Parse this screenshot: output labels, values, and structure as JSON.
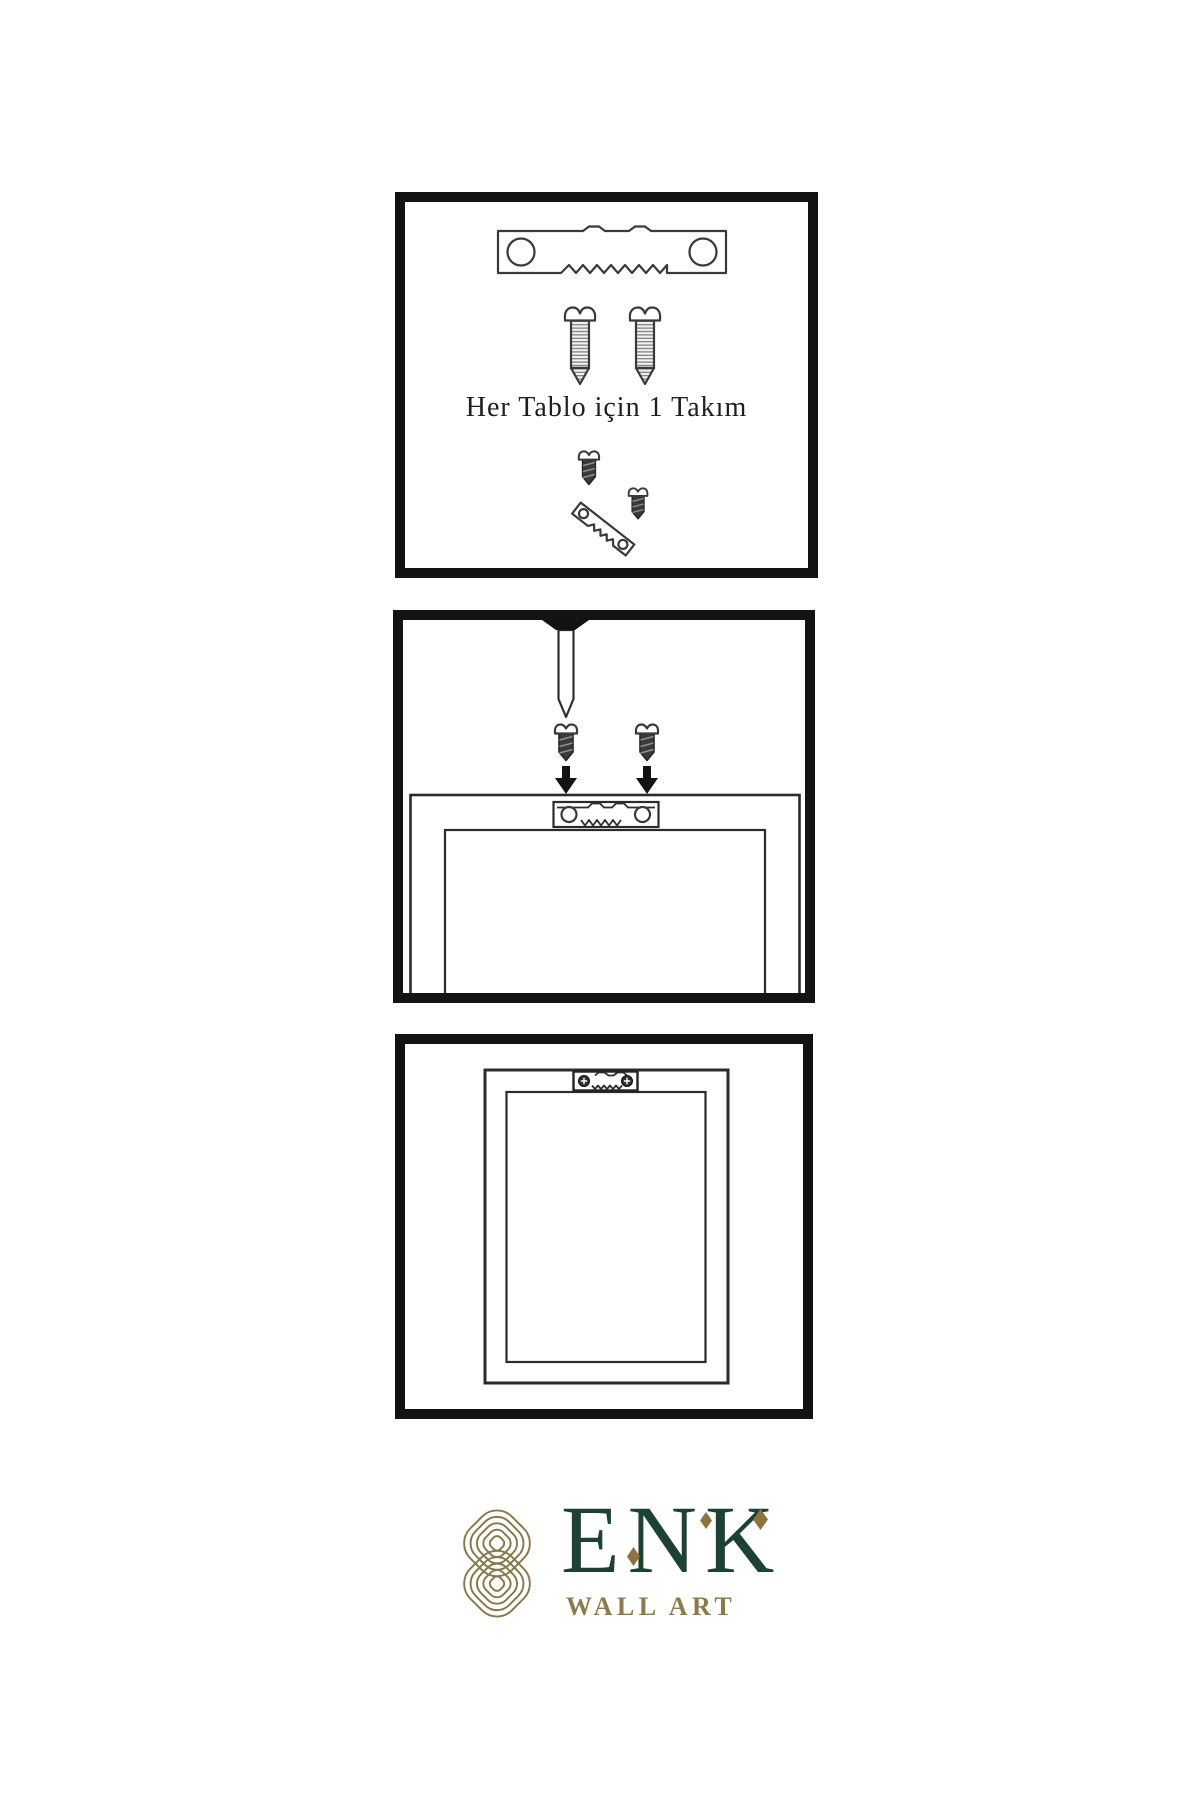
{
  "theme": {
    "paper": "#ffffff",
    "ink": "#131313",
    "outline": "#3a3a3a",
    "metal_dark": "#3a3a3a",
    "brand_green": "#1d4233",
    "brand_gold": "#8c7a4c",
    "knot_gold": "#85784a",
    "diamond_gold": "#8d7340"
  },
  "steps": {
    "step1": {
      "caption": "Her Tablo için 1 Takım",
      "parts": [
        "sawtooth-hanger",
        "mounting-screw",
        "mounting-screw",
        "assembled-hanger-kit"
      ]
    },
    "step2": {
      "parts": [
        "wall-nail",
        "mounting-screw",
        "mounting-screw",
        "down-arrow",
        "down-arrow",
        "frame-back",
        "sawtooth-hanger"
      ]
    },
    "step3": {
      "parts": [
        "mounted-frame",
        "sawtooth-hanger-installed"
      ]
    }
  },
  "logo": {
    "brand": "ENK",
    "subtitle": "WALL ART",
    "symbol": "interlocking-knot"
  }
}
